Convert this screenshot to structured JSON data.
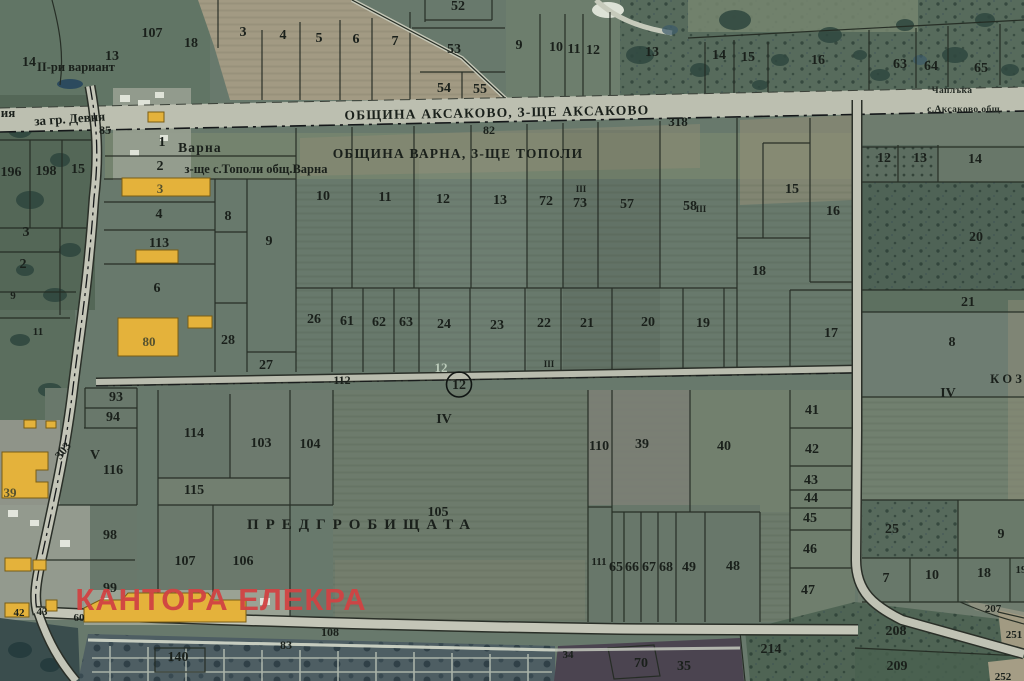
{
  "map": {
    "municipality_north": "ОБЩИНА АКСАКОВО, З-ЩЕ АКСАКОВО",
    "municipality_south": "ОБЩИНА ВАРНА, З-ЩЕ ТОПОЛИ",
    "localities": {
      "varna_strip": [
        "Варна",
        "з-ще с.Тополи общ.Варна"
      ],
      "pre_cemetery_field": "ПРЕДГРОБИЩАТА",
      "northeast": [
        "Чаплъка",
        "с.Аксаково общ."
      ],
      "east_partial": "К О З",
      "variant_note": "II-ри вариант"
    },
    "road_labels": {
      "to_city": "за гр. Девня",
      "numbers": [
        "318",
        "82",
        "85",
        "112",
        "108",
        "83",
        "303"
      ]
    },
    "survey_point": {
      "number": "12"
    },
    "watermark": "КАНТОРА ЕЛЕКРА",
    "colors": {
      "field_green": "#68796c",
      "forest_green": "#4f6454",
      "road_gray": "#bcbfb0",
      "boundary_dark": "#242b23",
      "building_yellow": "#e4b23b",
      "tan_field": "#a29a83",
      "cemetery_blue": "#4e5e63",
      "watermark_red": "#d14343"
    },
    "labels": [
      {
        "t": "14",
        "x": 29,
        "y": 66
      },
      {
        "t": "13",
        "x": 112,
        "y": 60
      },
      {
        "t": "II-ри вариант",
        "x": 76,
        "y": 71,
        "c": "region-sm"
      },
      {
        "t": "107",
        "x": 152,
        "y": 37
      },
      {
        "t": "18",
        "x": 191,
        "y": 47
      },
      {
        "t": "3",
        "x": 243,
        "y": 36
      },
      {
        "t": "4",
        "x": 283,
        "y": 39
      },
      {
        "t": "5",
        "x": 319,
        "y": 42
      },
      {
        "t": "52",
        "x": 458,
        "y": 10
      },
      {
        "t": "6",
        "x": 356,
        "y": 43
      },
      {
        "t": "7",
        "x": 395,
        "y": 45
      },
      {
        "t": "53",
        "x": 454,
        "y": 53
      },
      {
        "t": "9",
        "x": 519,
        "y": 49
      },
      {
        "t": "10",
        "x": 556,
        "y": 51
      },
      {
        "t": "11",
        "x": 574,
        "y": 53
      },
      {
        "t": "12",
        "x": 593,
        "y": 54
      },
      {
        "t": "13",
        "x": 652,
        "y": 56
      },
      {
        "t": "54",
        "x": 444,
        "y": 92
      },
      {
        "t": "55",
        "x": 480,
        "y": 93
      },
      {
        "t": "14",
        "x": 719,
        "y": 59
      },
      {
        "t": "15",
        "x": 748,
        "y": 61
      },
      {
        "t": "16",
        "x": 818,
        "y": 64
      },
      {
        "t": "63",
        "x": 900,
        "y": 68
      },
      {
        "t": "64",
        "x": 931,
        "y": 70
      },
      {
        "t": "65",
        "x": 981,
        "y": 72
      },
      {
        "t": "Чаплъка",
        "x": 952,
        "y": 93,
        "c": "locality"
      },
      {
        "t": "с.Аксаково общ.",
        "x": 965,
        "y": 112,
        "c": "locality"
      },
      {
        "t": "ОБЩИНА АКСАКОВО, З-ЩЕ АКСАКОВО",
        "x": 497,
        "y": 117,
        "c": "region",
        "rot": -1
      },
      {
        "t": "318",
        "x": 678,
        "y": 126,
        "c": "road"
      },
      {
        "t": "82",
        "x": 489,
        "y": 134,
        "c": "road-sm"
      },
      {
        "t": "ия",
        "x": 8,
        "y": 117,
        "c": "road"
      },
      {
        "t": "за гр. Девня",
        "x": 70,
        "y": 123,
        "c": "road",
        "rot": -4
      },
      {
        "t": "85",
        "x": 105,
        "y": 134,
        "c": "road-sm"
      },
      {
        "t": "196",
        "x": 11,
        "y": 176
      },
      {
        "t": "198",
        "x": 46,
        "y": 175
      },
      {
        "t": "15",
        "x": 78,
        "y": 173
      },
      {
        "t": "3",
        "x": 26,
        "y": 236
      },
      {
        "t": "2",
        "x": 23,
        "y": 268
      },
      {
        "t": "9",
        "x": 13,
        "y": 299,
        "c": "parcel-sm"
      },
      {
        "t": "11",
        "x": 38,
        "y": 335,
        "c": "parcel-sm"
      },
      {
        "t": "1",
        "x": 162,
        "y": 146
      },
      {
        "t": "Варна",
        "x": 200,
        "y": 152,
        "c": "region"
      },
      {
        "t": "2",
        "x": 160,
        "y": 170
      },
      {
        "t": "з-ще с.Тополи общ.Варна",
        "x": 256,
        "y": 173,
        "c": "region-sm"
      },
      {
        "t": "ОБЩИНА ВАРНА, З-ЩЕ ТОПОЛИ",
        "x": 458,
        "y": 158,
        "c": "region"
      },
      {
        "t": "3",
        "x": 160,
        "y": 193,
        "c": "bld"
      },
      {
        "t": "4",
        "x": 159,
        "y": 218
      },
      {
        "t": "113",
        "x": 159,
        "y": 247
      },
      {
        "t": "8",
        "x": 228,
        "y": 220
      },
      {
        "t": "9",
        "x": 269,
        "y": 245
      },
      {
        "t": "6",
        "x": 157,
        "y": 292
      },
      {
        "t": "80",
        "x": 149,
        "y": 346,
        "c": "bld"
      },
      {
        "t": "28",
        "x": 228,
        "y": 344
      },
      {
        "t": "27",
        "x": 266,
        "y": 369
      },
      {
        "t": "26",
        "x": 314,
        "y": 323
      },
      {
        "t": "61",
        "x": 347,
        "y": 325
      },
      {
        "t": "62",
        "x": 379,
        "y": 326
      },
      {
        "t": "63",
        "x": 406,
        "y": 326
      },
      {
        "t": "24",
        "x": 444,
        "y": 328
      },
      {
        "t": "23",
        "x": 497,
        "y": 329
      },
      {
        "t": "22",
        "x": 544,
        "y": 327
      },
      {
        "t": "21",
        "x": 587,
        "y": 327
      },
      {
        "t": "20",
        "x": 648,
        "y": 326
      },
      {
        "t": "19",
        "x": 703,
        "y": 327
      },
      {
        "t": "18",
        "x": 759,
        "y": 275
      },
      {
        "t": "17",
        "x": 831,
        "y": 337
      },
      {
        "t": "III",
        "x": 549,
        "y": 367,
        "c": "tiny"
      },
      {
        "t": "III",
        "x": 581,
        "y": 192,
        "c": "tiny"
      },
      {
        "t": "III",
        "x": 701,
        "y": 212,
        "c": "tiny"
      },
      {
        "t": "10",
        "x": 323,
        "y": 200
      },
      {
        "t": "11",
        "x": 385,
        "y": 201
      },
      {
        "t": "12",
        "x": 443,
        "y": 203
      },
      {
        "t": "13",
        "x": 500,
        "y": 204
      },
      {
        "t": "72",
        "x": 546,
        "y": 205
      },
      {
        "t": "73",
        "x": 580,
        "y": 207
      },
      {
        "t": "57",
        "x": 627,
        "y": 208
      },
      {
        "t": "58",
        "x": 690,
        "y": 210
      },
      {
        "t": "15",
        "x": 792,
        "y": 193
      },
      {
        "t": "16",
        "x": 833,
        "y": 215
      },
      {
        "t": "12",
        "x": 884,
        "y": 162
      },
      {
        "t": "13",
        "x": 920,
        "y": 162
      },
      {
        "t": "14",
        "x": 975,
        "y": 163
      },
      {
        "t": "20",
        "x": 976,
        "y": 241
      },
      {
        "t": "21",
        "x": 968,
        "y": 306
      },
      {
        "t": "8",
        "x": 952,
        "y": 346
      },
      {
        "t": "К О З",
        "x": 1006,
        "y": 383,
        "c": "region-sm"
      },
      {
        "t": "IV",
        "x": 948,
        "y": 397
      },
      {
        "t": "93",
        "x": 116,
        "y": 401
      },
      {
        "t": "94",
        "x": 113,
        "y": 421
      },
      {
        "t": "V",
        "x": 95,
        "y": 459
      },
      {
        "t": "116",
        "x": 113,
        "y": 474
      },
      {
        "t": "303",
        "x": 66,
        "y": 453,
        "c": "road-sm",
        "rot": -52
      },
      {
        "t": "114",
        "x": 194,
        "y": 437
      },
      {
        "t": "115",
        "x": 194,
        "y": 494
      },
      {
        "t": "103",
        "x": 261,
        "y": 447
      },
      {
        "t": "104",
        "x": 310,
        "y": 448
      },
      {
        "t": "98",
        "x": 110,
        "y": 539
      },
      {
        "t": "99",
        "x": 110,
        "y": 592
      },
      {
        "t": "39",
        "x": 10,
        "y": 497,
        "c": "bld"
      },
      {
        "t": "42",
        "x": 19,
        "y": 616,
        "c": "parcel-sm"
      },
      {
        "t": "43",
        "x": 42,
        "y": 615,
        "c": "parcel-sm"
      },
      {
        "t": "60",
        "x": 79,
        "y": 621,
        "c": "parcel-sm"
      },
      {
        "t": "112",
        "x": 342,
        "y": 384,
        "c": "road-sm"
      },
      {
        "t": "12",
        "x": 441,
        "y": 372,
        "c": "faint"
      },
      {
        "t": "12",
        "x": 459,
        "y": 389,
        "c": "circled"
      },
      {
        "t": "IV",
        "x": 444,
        "y": 423
      },
      {
        "t": "110",
        "x": 599,
        "y": 450
      },
      {
        "t": "39",
        "x": 642,
        "y": 448
      },
      {
        "t": "40",
        "x": 724,
        "y": 450
      },
      {
        "t": "41",
        "x": 812,
        "y": 414
      },
      {
        "t": "42",
        "x": 812,
        "y": 453
      },
      {
        "t": "43",
        "x": 811,
        "y": 484
      },
      {
        "t": "44",
        "x": 811,
        "y": 502
      },
      {
        "t": "45",
        "x": 810,
        "y": 522
      },
      {
        "t": "46",
        "x": 810,
        "y": 553
      },
      {
        "t": "47",
        "x": 808,
        "y": 594
      },
      {
        "t": "105",
        "x": 438,
        "y": 516
      },
      {
        "t": "ПРЕДГРОБИЩАТА",
        "x": 362,
        "y": 529,
        "c": "spaced"
      },
      {
        "t": "107",
        "x": 185,
        "y": 565
      },
      {
        "t": "106",
        "x": 243,
        "y": 565
      },
      {
        "t": "111",
        "x": 599,
        "y": 565,
        "c": "parcel-sm"
      },
      {
        "t": "65",
        "x": 616,
        "y": 571
      },
      {
        "t": "66",
        "x": 632,
        "y": 571
      },
      {
        "t": "67",
        "x": 649,
        "y": 571
      },
      {
        "t": "68",
        "x": 666,
        "y": 571
      },
      {
        "t": "49",
        "x": 689,
        "y": 571
      },
      {
        "t": "48",
        "x": 733,
        "y": 570
      },
      {
        "t": "25",
        "x": 892,
        "y": 533
      },
      {
        "t": "9",
        "x": 1001,
        "y": 538
      },
      {
        "t": "7",
        "x": 886,
        "y": 582
      },
      {
        "t": "10",
        "x": 932,
        "y": 579
      },
      {
        "t": "18",
        "x": 984,
        "y": 577
      },
      {
        "t": "19",
        "x": 1021,
        "y": 573,
        "c": "parcel-sm"
      },
      {
        "t": "207",
        "x": 993,
        "y": 612,
        "c": "parcel-sm"
      },
      {
        "t": "208",
        "x": 896,
        "y": 635
      },
      {
        "t": "209",
        "x": 897,
        "y": 670
      },
      {
        "t": "251",
        "x": 1014,
        "y": 638,
        "c": "parcel-sm"
      },
      {
        "t": "252",
        "x": 1003,
        "y": 680,
        "c": "parcel-sm"
      },
      {
        "t": "214",
        "x": 771,
        "y": 653
      },
      {
        "t": "70",
        "x": 641,
        "y": 667
      },
      {
        "t": "35",
        "x": 684,
        "y": 670
      },
      {
        "t": "34",
        "x": 568,
        "y": 658,
        "c": "parcel-sm"
      },
      {
        "t": "108",
        "x": 330,
        "y": 636,
        "c": "road-sm"
      },
      {
        "t": "83",
        "x": 286,
        "y": 649,
        "c": "road-sm"
      },
      {
        "t": "140",
        "x": 178,
        "y": 661
      },
      {
        "t": "КАНТОРА ЕЛЕКРА",
        "x": 221,
        "y": 610,
        "c": "brand"
      }
    ]
  }
}
